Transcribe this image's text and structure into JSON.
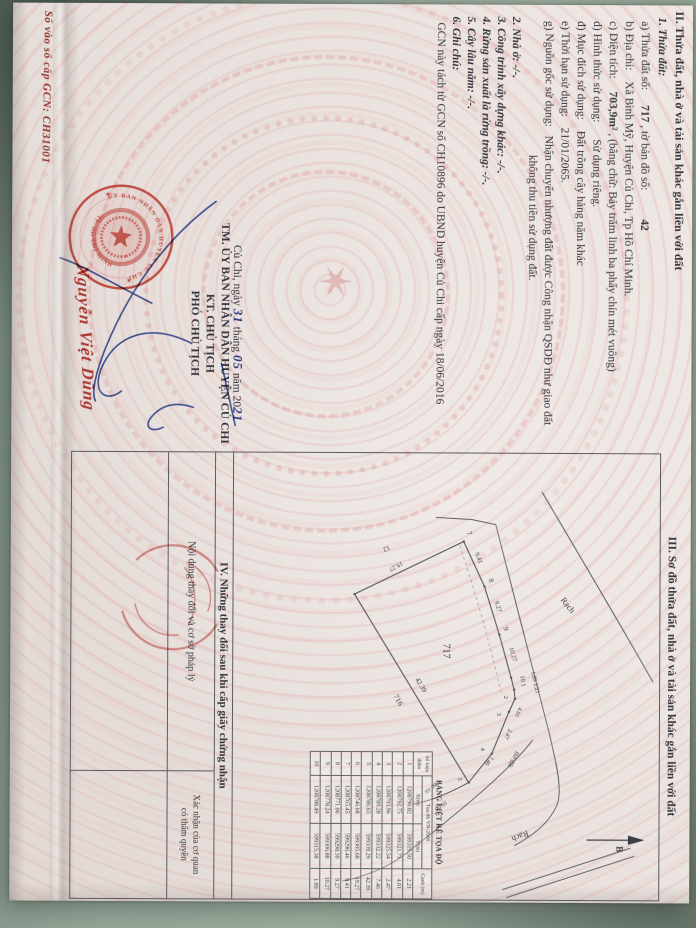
{
  "page": {
    "so_vao_so": "Số vào sổ cấp GCN: CH31001"
  },
  "section2": {
    "heading": "II. Thửa đất, nhà ở và tài sản khác gắn liền với đất",
    "item1": "1. Thửa đất:",
    "a_label": "a) Thửa đất số:",
    "a_value": "717",
    "a_label2": ", tờ bản đồ số:",
    "a_value2": "42",
    "b_label": "b) Địa chỉ:",
    "b_value": "Xã Bình Mỹ, Huyện Củ Chi, Tp Hồ Chí Minh.",
    "c_label": "c) Diện tích:",
    "c_value": "703,9m²",
    "c_value2": ", (bằng chữ: Bảy trăm linh ba phẩy chín mét vuông)",
    "d_label": "d) Hình thức sử dụng:",
    "d_value": "Sử dụng riêng.",
    "dd_label": "đ) Mục đích sử dụng:",
    "dd_value": "Đất trồng cây hàng năm khác",
    "e_label": "e) Thời hạn sử dụng:",
    "e_value": "21/01/2065.",
    "g_label": "g) Nguồn gốc sử dụng:",
    "g_value": "Nhận chuyển nhượng đất được Công nhận QSDĐ như giao đất",
    "g_value2": "không thu tiền sử dụng đất.",
    "item2": "2. Nhà ở: -/-.",
    "item3": "3. Công trình xây dựng khác: -/-.",
    "item4": "4. Rừng sản xuất là rừng trồng: -/-.",
    "item5": "5. Cây lâu năm: -/-.",
    "item6": "6. Ghi chú:",
    "note": "GCN này tách từ GCN số CH10896 do UBND huyện Củ Chi cấp ngày 18/06/2016"
  },
  "signature": {
    "place": "Củ Chi, ngày",
    "day": "31",
    "thang": "tháng",
    "month": "05",
    "nam": "năm 20",
    "year": "21",
    "line2": "TM. ỦY BAN NHÂN DÂN HUYỆN CỦ CHI",
    "line3": "KT. CHỦ TỊCH",
    "line4": "PHÓ CHỦ TỊCH",
    "signer_name": "Nguyễn Việt Dũng",
    "seal_top": "ỦY BAN NHÂN DÂN HUYỆN CỦ CHI",
    "seal_bottom": "TP. HỒ CHÍ MINH",
    "ink_blue": "#2f49a0",
    "seal_red": "#cf4438"
  },
  "section3": {
    "heading": "III. Sơ đồ thửa đất, nhà ở và tài sản khác gắn liền với đất",
    "labels": [
      {
        "t": "7",
        "x": 79,
        "y": 193,
        "r": -22,
        "s": 7
      },
      {
        "t": "9.41",
        "x": 100,
        "y": 185,
        "r": -24,
        "s": 6.5
      },
      {
        "t": "8",
        "x": 126,
        "y": 171,
        "r": -20,
        "s": 7
      },
      {
        "t": "9.27",
        "x": 148,
        "y": 165,
        "r": -18,
        "s": 6.5
      },
      {
        "t": "9",
        "x": 174,
        "y": 156,
        "r": -16,
        "s": 7
      },
      {
        "t": "10.27",
        "x": 194,
        "y": 150,
        "r": -15,
        "s": 6.5
      },
      {
        "t": "1.89 2.21",
        "x": 218,
        "y": 128,
        "r": -13,
        "s": 6
      },
      {
        "t": "10 1",
        "x": 222,
        "y": 139,
        "r": -10,
        "s": 6.5
      },
      {
        "t": "2",
        "x": 242,
        "y": 155,
        "r": 0,
        "s": 6.5
      },
      {
        "t": "4.01",
        "x": 253,
        "y": 140,
        "r": 24,
        "s": 6
      },
      {
        "t": "3",
        "x": 259,
        "y": 162,
        "r": 0,
        "s": 6.5
      },
      {
        "t": "2.47",
        "x": 275,
        "y": 150,
        "r": 27,
        "s": 6
      },
      {
        "t": "4",
        "x": 294,
        "y": 178,
        "r": 0,
        "s": 6.5
      },
      {
        "t": "7.46",
        "x": 302,
        "y": 168,
        "r": 36,
        "s": 6
      },
      {
        "t": "5",
        "x": 324,
        "y": 201,
        "r": 0,
        "s": 6.5
      },
      {
        "t": "10.00",
        "x": 347,
        "y": 213,
        "r": 55,
        "s": 6
      },
      {
        "t": "42.39",
        "x": 226,
        "y": 244,
        "r": -31,
        "s": 7
      },
      {
        "t": "716",
        "x": 243,
        "y": 266,
        "r": -31,
        "s": 8
      },
      {
        "t": "717",
        "x": 190,
        "y": 216,
        "r": 0,
        "s": 10
      },
      {
        "t": "12",
        "x": 92,
        "y": 271,
        "r": 62,
        "s": 7
      },
      {
        "t": "19.27",
        "x": 108,
        "y": 258,
        "r": 62,
        "s": 6.5
      },
      {
        "t": "Rạch",
        "x": 146,
        "y": 99,
        "r": -38,
        "s": 8.5
      },
      {
        "t": "Rạch",
        "x": 377,
        "y": 131,
        "r": 70,
        "s": 8.5
      },
      {
        "t": "Bờ đất",
        "x": 297,
        "y": 143,
        "r": 28,
        "s": 6.5
      },
      {
        "t": "Bờ đất",
        "x": 329,
        "y": 223,
        "r": 52,
        "s": 5.5
      },
      {
        "t": "B",
        "x": 392,
        "y": 42,
        "r": 0,
        "s": 9,
        "b": 1
      }
    ]
  },
  "coord_table": {
    "title": "BẢNG LIỆT KÊ TỌA ĐỘ",
    "col_point": "Số hiệu điểm",
    "col_group": "Tọa độ VN-2000",
    "col_x": "X(m)",
    "col_y": "Y(m)",
    "col_edge": "Cạnh (m)",
    "rows": [
      [
        "1",
        "1208790.82",
        "599319.50",
        "2.21"
      ],
      [
        "2",
        "1208792.75",
        "599321.71",
        "4.01"
      ],
      [
        "3",
        "1208793.96",
        "599325.54",
        "2.47"
      ],
      [
        "4",
        "1208789.28",
        "599332.22",
        "7.46"
      ],
      [
        "5",
        "1208786.63",
        "599339.29",
        "42.39"
      ],
      [
        "6",
        "1208746.68",
        "599305.68",
        "19.27"
      ],
      [
        "7",
        "1208765.45",
        "599296.46",
        "9.41"
      ],
      [
        "8",
        "1208771.06",
        "599298.30",
        "9.27"
      ],
      [
        "9",
        "1208778.24",
        "599306.88",
        "10.27"
      ],
      [
        "10",
        "1208788.49",
        "599315.38",
        "1.89"
      ]
    ]
  },
  "section4": {
    "heading": "IV. Những thay đổi sau khi cấp giấy chứng nhận",
    "col_left": "Nội dung thay đổi và cơ sở pháp lý",
    "col_right_1": "Xác nhận của cơ quan",
    "col_right_2": "có thẩm quyền"
  }
}
